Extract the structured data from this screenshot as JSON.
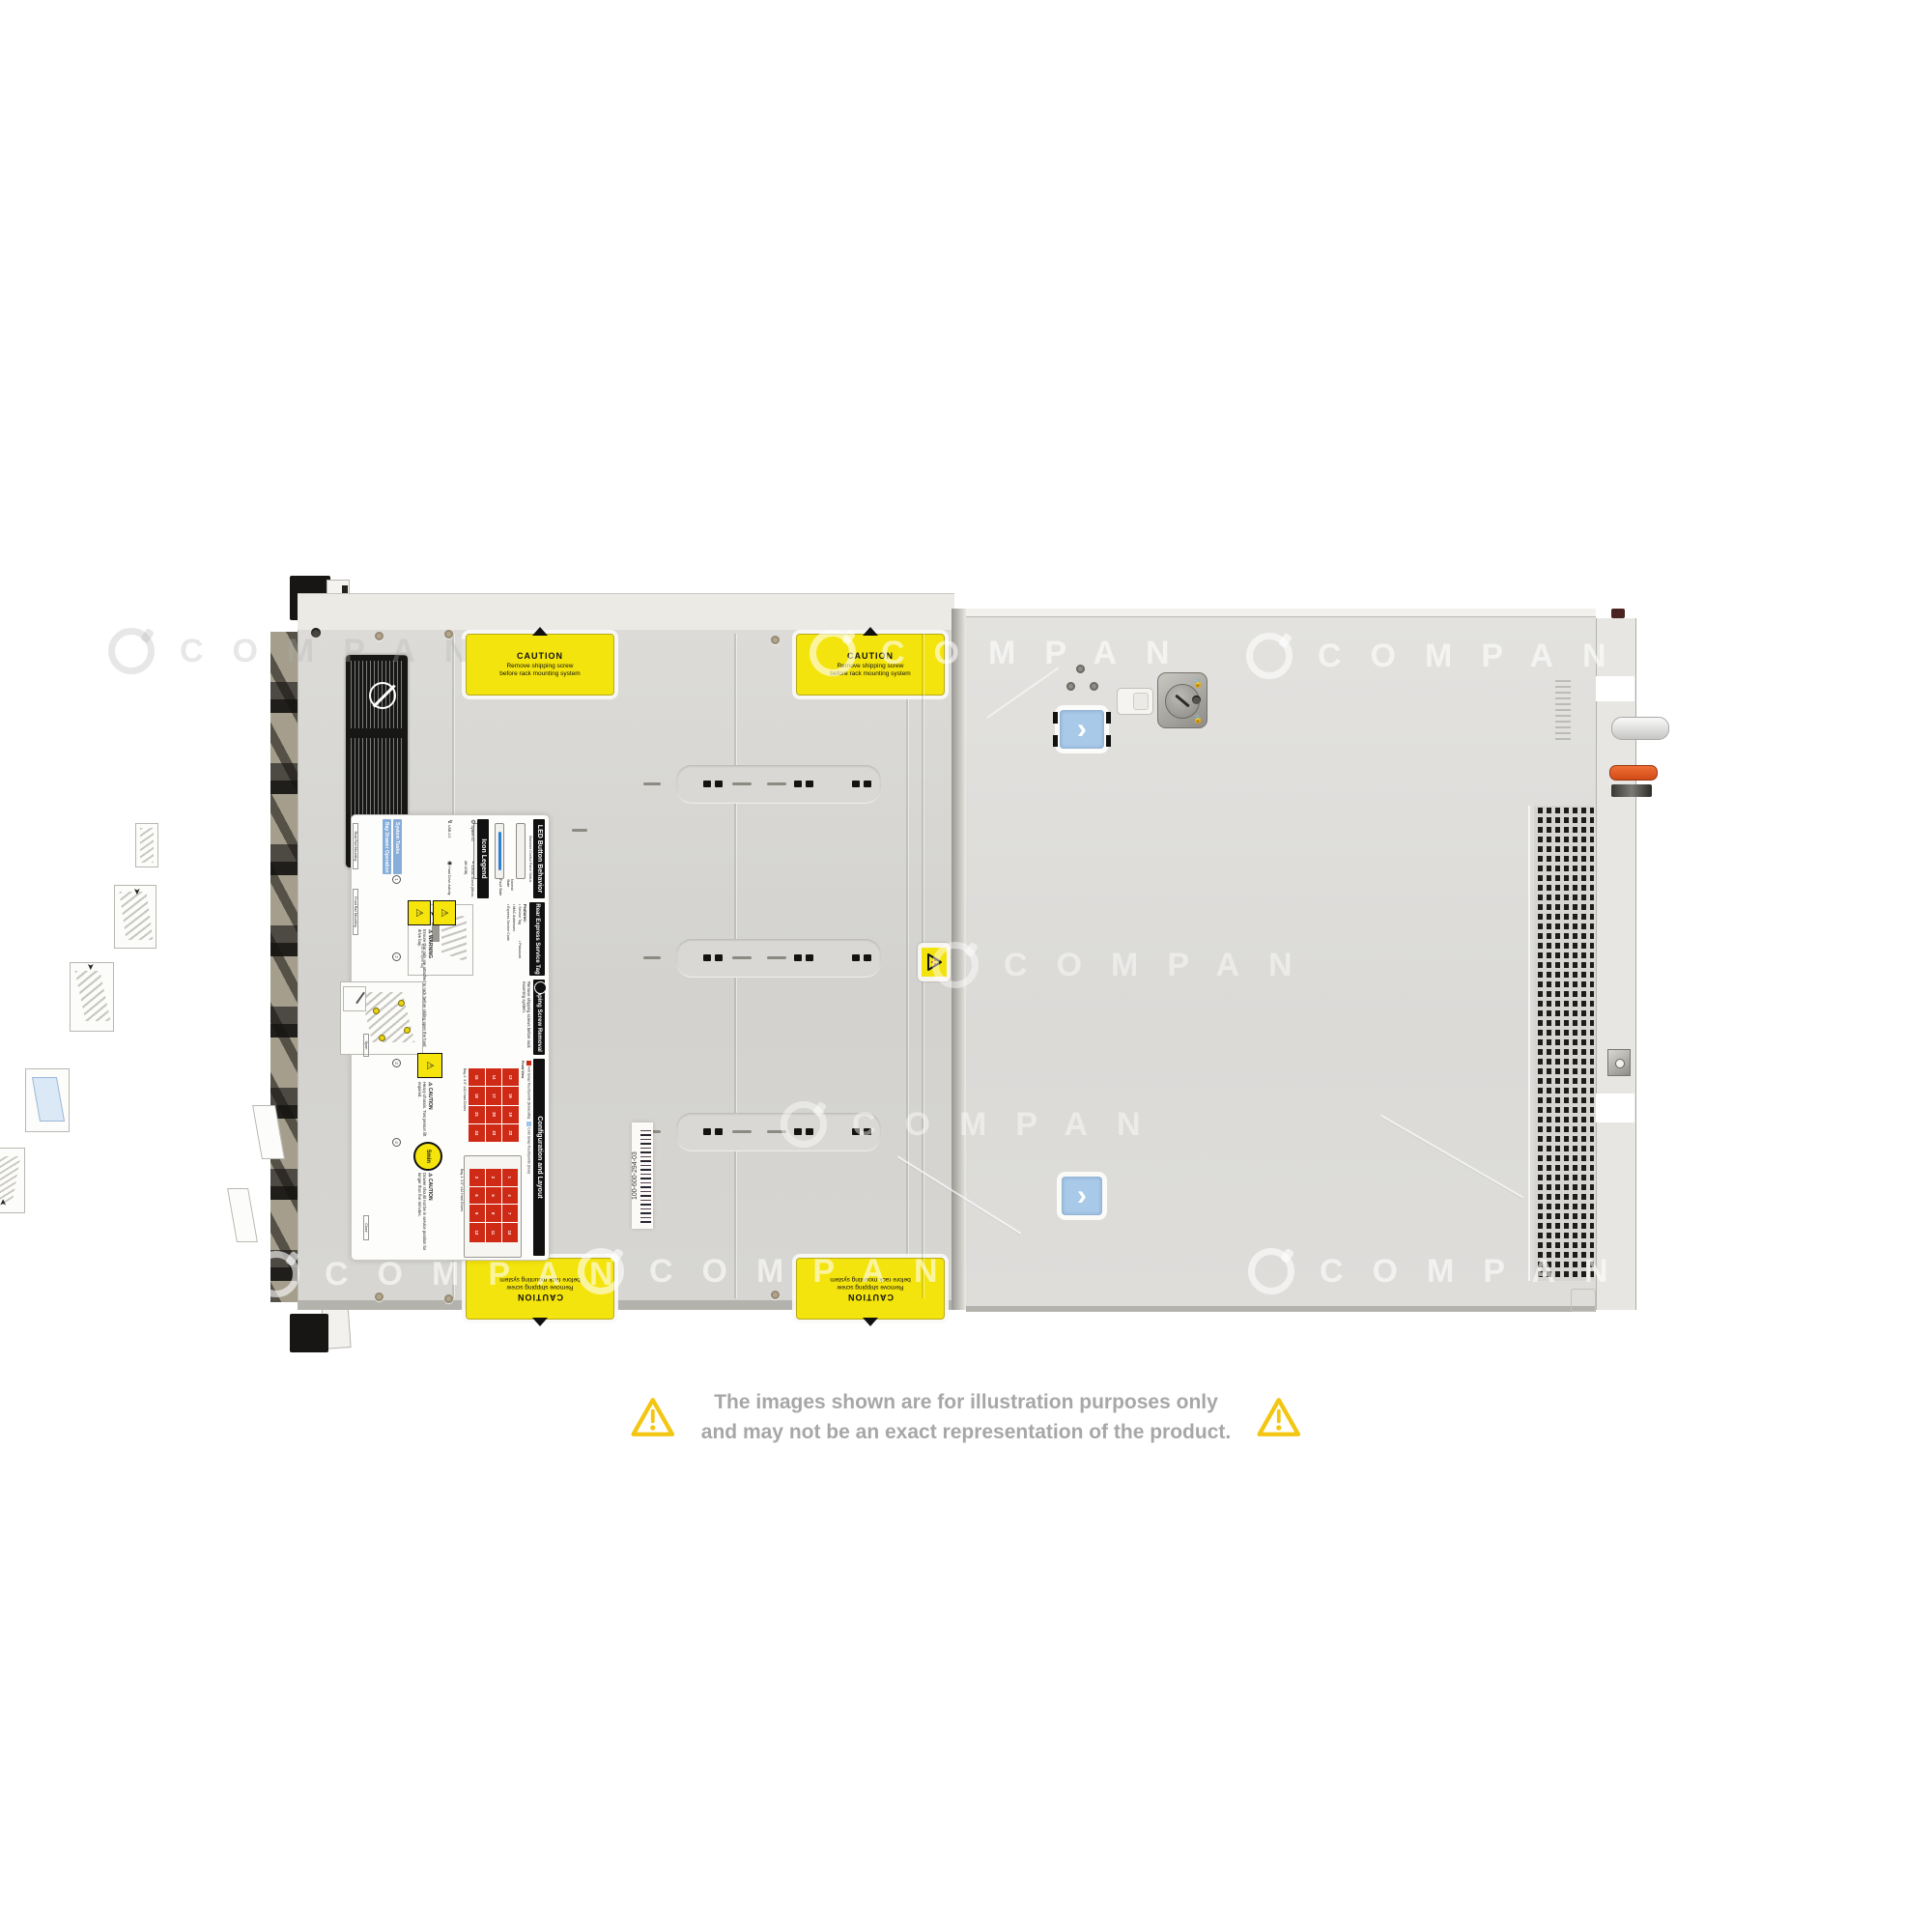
{
  "watermark": {
    "text": "COMPAN"
  },
  "disclaimer": {
    "line1": "The images shown are for illustration purposes only",
    "line2": "and may not be an exact representation of the product."
  },
  "caution_sticker": {
    "title": "CAUTION",
    "line1": "Remove shipping screw",
    "line2": "before rack mounting system"
  },
  "barcode_label": {
    "text": "100-600-294-03"
  },
  "instruction_label": {
    "led": {
      "title": "LED Button Behavior",
      "subtitle": "Standard Control Panel Status",
      "normal": "Normal State",
      "fault": "Fault State"
    },
    "icon_legend": {
      "title": "Icon Legend",
      "items": [
        "System ID",
        "iDRAC Direct (Micro-AB USB)",
        "USB 2.0",
        "Hard Drive Activity"
      ]
    },
    "service_tag": {
      "title": "Rear Express Service Tag",
      "features_heading": "Features:",
      "features": [
        "Service Tag",
        "Password",
        "MAC Addresses",
        "Express Service Code"
      ],
      "pull": "Pull to open tag"
    },
    "shipping": {
      "title": "Shipping Screw Removal",
      "body": "Remove shipping screws before rack mounting system."
    },
    "config": {
      "title": "Configuration and Layout",
      "legend_hot": "Hot Swap Touchpoints (terracotta)",
      "legend_cold": "Cold Swap Touchpoints (blue)",
      "front_view": "Front View",
      "bay1_caption": "Bay 1: 3.5\" x12 Hard Drives",
      "bay2_caption": "Bay 2: 3.5\" x12 Hard Drives",
      "bay1_numbers": [
        "1",
        "2",
        "3",
        "4",
        "5",
        "6",
        "7",
        "8",
        "9",
        "10",
        "11",
        "12"
      ],
      "bay2_numbers": [
        "13",
        "14",
        "15",
        "16",
        "17",
        "18",
        "19",
        "20",
        "21",
        "22",
        "23",
        "24"
      ]
    },
    "warning": {
      "title": "WARNING",
      "body": "Ensure that rails are attached to rack before sliding open the hard drive bay."
    },
    "caution_heavy": {
      "title": "CAUTION",
      "body": "Heavy chassis. Two person lift required."
    },
    "caution_drawer": {
      "title": "CAUTION",
      "body": "Drawer should not be in service position for longer than five minutes."
    },
    "five_min": "5min",
    "tasks": {
      "header1": "System Tasks",
      "header2": "Bay Drawer Operation",
      "rear_rail": "Rear Rail Mounting",
      "front_rail": "Front Rail Mounting",
      "open": "Open",
      "close": "Close",
      "steps": [
        "1",
        "2",
        "3",
        "4"
      ]
    }
  },
  "colors": {
    "caution_yellow": "#f4e40d",
    "warning_triangle_yellow": "#f3c613",
    "touchpoint_blue": "#a9c9e9",
    "latch_orange": "#e4571f",
    "status_normal_blue": "#2f7fd0",
    "status_fault_amber": "#f09d1c",
    "hot_swap_red": "#cf2a16",
    "cold_swap_blue": "#9fc5e8",
    "chassis_gray": "#d7d6d3"
  }
}
